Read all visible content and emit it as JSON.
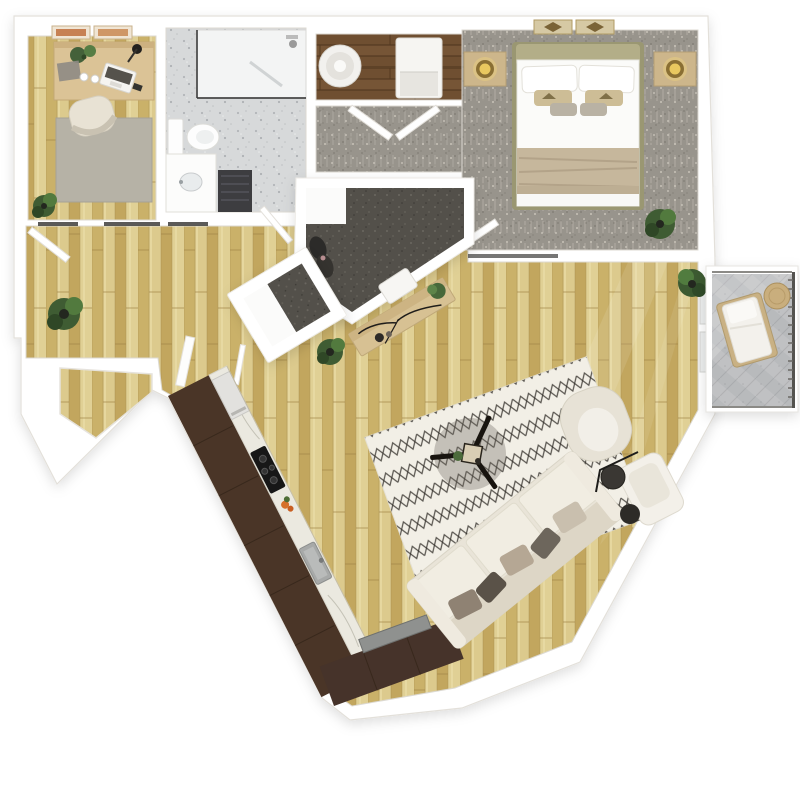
{
  "meta": {
    "title": "3D apartment floor plan — top-down rendering",
    "type": "floor-plan-rendering",
    "canvas": "800x800"
  },
  "palette": {
    "background": "#ffffff",
    "walls": "#ffffff",
    "wall_outline": "#dedad3",
    "oak_floor": "#d4c07f",
    "dark_wood_floor": "#6f4f31",
    "carpet_gray": "#98948c",
    "carpet_dark": "#53504a",
    "bath_tile": "#d7d9da",
    "kitchen_cabinet": "#4a3527",
    "marble_counter": "#ebe9e0",
    "sofa_cream": "#e9e4d8",
    "rug_ivory": "#f2efe6",
    "rug_zigzag": "#33302b",
    "accent_gold": "#e9c85f",
    "plant_green": "#527a3e",
    "balcony_concrete": "#c0c1c3",
    "tv_gray": "#8f918f",
    "mat_charcoal": "#3d3d40"
  },
  "rooms": [
    {
      "id": "office",
      "name": "home-office",
      "floor": "oak wood",
      "furniture": [
        "desk",
        "laptop",
        "desk-lamp",
        "desk-plants",
        "office-chair",
        "gray-rug",
        "floor-plant",
        "two-wall-art-frames"
      ]
    },
    {
      "id": "bathroom",
      "name": "bathroom",
      "floor": "speckled tile",
      "furniture": [
        "walk-in-shower",
        "toilet",
        "vanity-sink",
        "charcoal-bath-mat",
        "door"
      ]
    },
    {
      "id": "laundry",
      "name": "laundry-closet",
      "floor": "dark wood",
      "furniture": [
        "round-hamper",
        "washer-dryer"
      ]
    },
    {
      "id": "closet-corridor",
      "name": "bedroom-entry-closet",
      "floor": "gray carpet",
      "furniture": [
        "double-doors"
      ]
    },
    {
      "id": "bedroom",
      "name": "bedroom",
      "floor": "gray carpet",
      "furniture": [
        "queen-bed",
        "white-bedding",
        "tan-throw-blanket",
        "pillows",
        "nightstand-left",
        "nightstand-right",
        "gold-lamps",
        "two-wall-art-frames",
        "plant",
        "door"
      ]
    },
    {
      "id": "walk-in-closet",
      "name": "walk-in-closet",
      "floor": "dark carpet",
      "furniture": [
        "hanging-clothes",
        "bench"
      ]
    },
    {
      "id": "entry",
      "name": "entry-nook",
      "floor": "dark carpet mat",
      "furniture": [
        "coat-closet",
        "door",
        "console-table",
        "decor-branches",
        "potted-plants"
      ]
    },
    {
      "id": "kitchen",
      "name": "kitchen",
      "floor": "oak wood",
      "furniture": [
        "espresso-cabinets",
        "marble-counter",
        "cooktop",
        "sink",
        "fridge",
        "fruit-bowl"
      ]
    },
    {
      "id": "dining",
      "name": "dining-area",
      "floor": "oak wood",
      "furniture": [
        "marble-dining-table",
        "two-chairs",
        "centerpiece-plant"
      ]
    },
    {
      "id": "living",
      "name": "living-room",
      "floor": "oak wood",
      "furniture": [
        "zigzag-area-rug",
        "tripod-coffee-table",
        "three-seat-sofa",
        "throw-pillows",
        "accent-chair",
        "armchair",
        "side-tables",
        "floor-lamp",
        "tv-console",
        "tv",
        "plants"
      ]
    },
    {
      "id": "balcony",
      "name": "balcony",
      "floor": "concrete",
      "furniture": [
        "lounge-chair",
        "round-side-table",
        "railing"
      ]
    }
  ]
}
